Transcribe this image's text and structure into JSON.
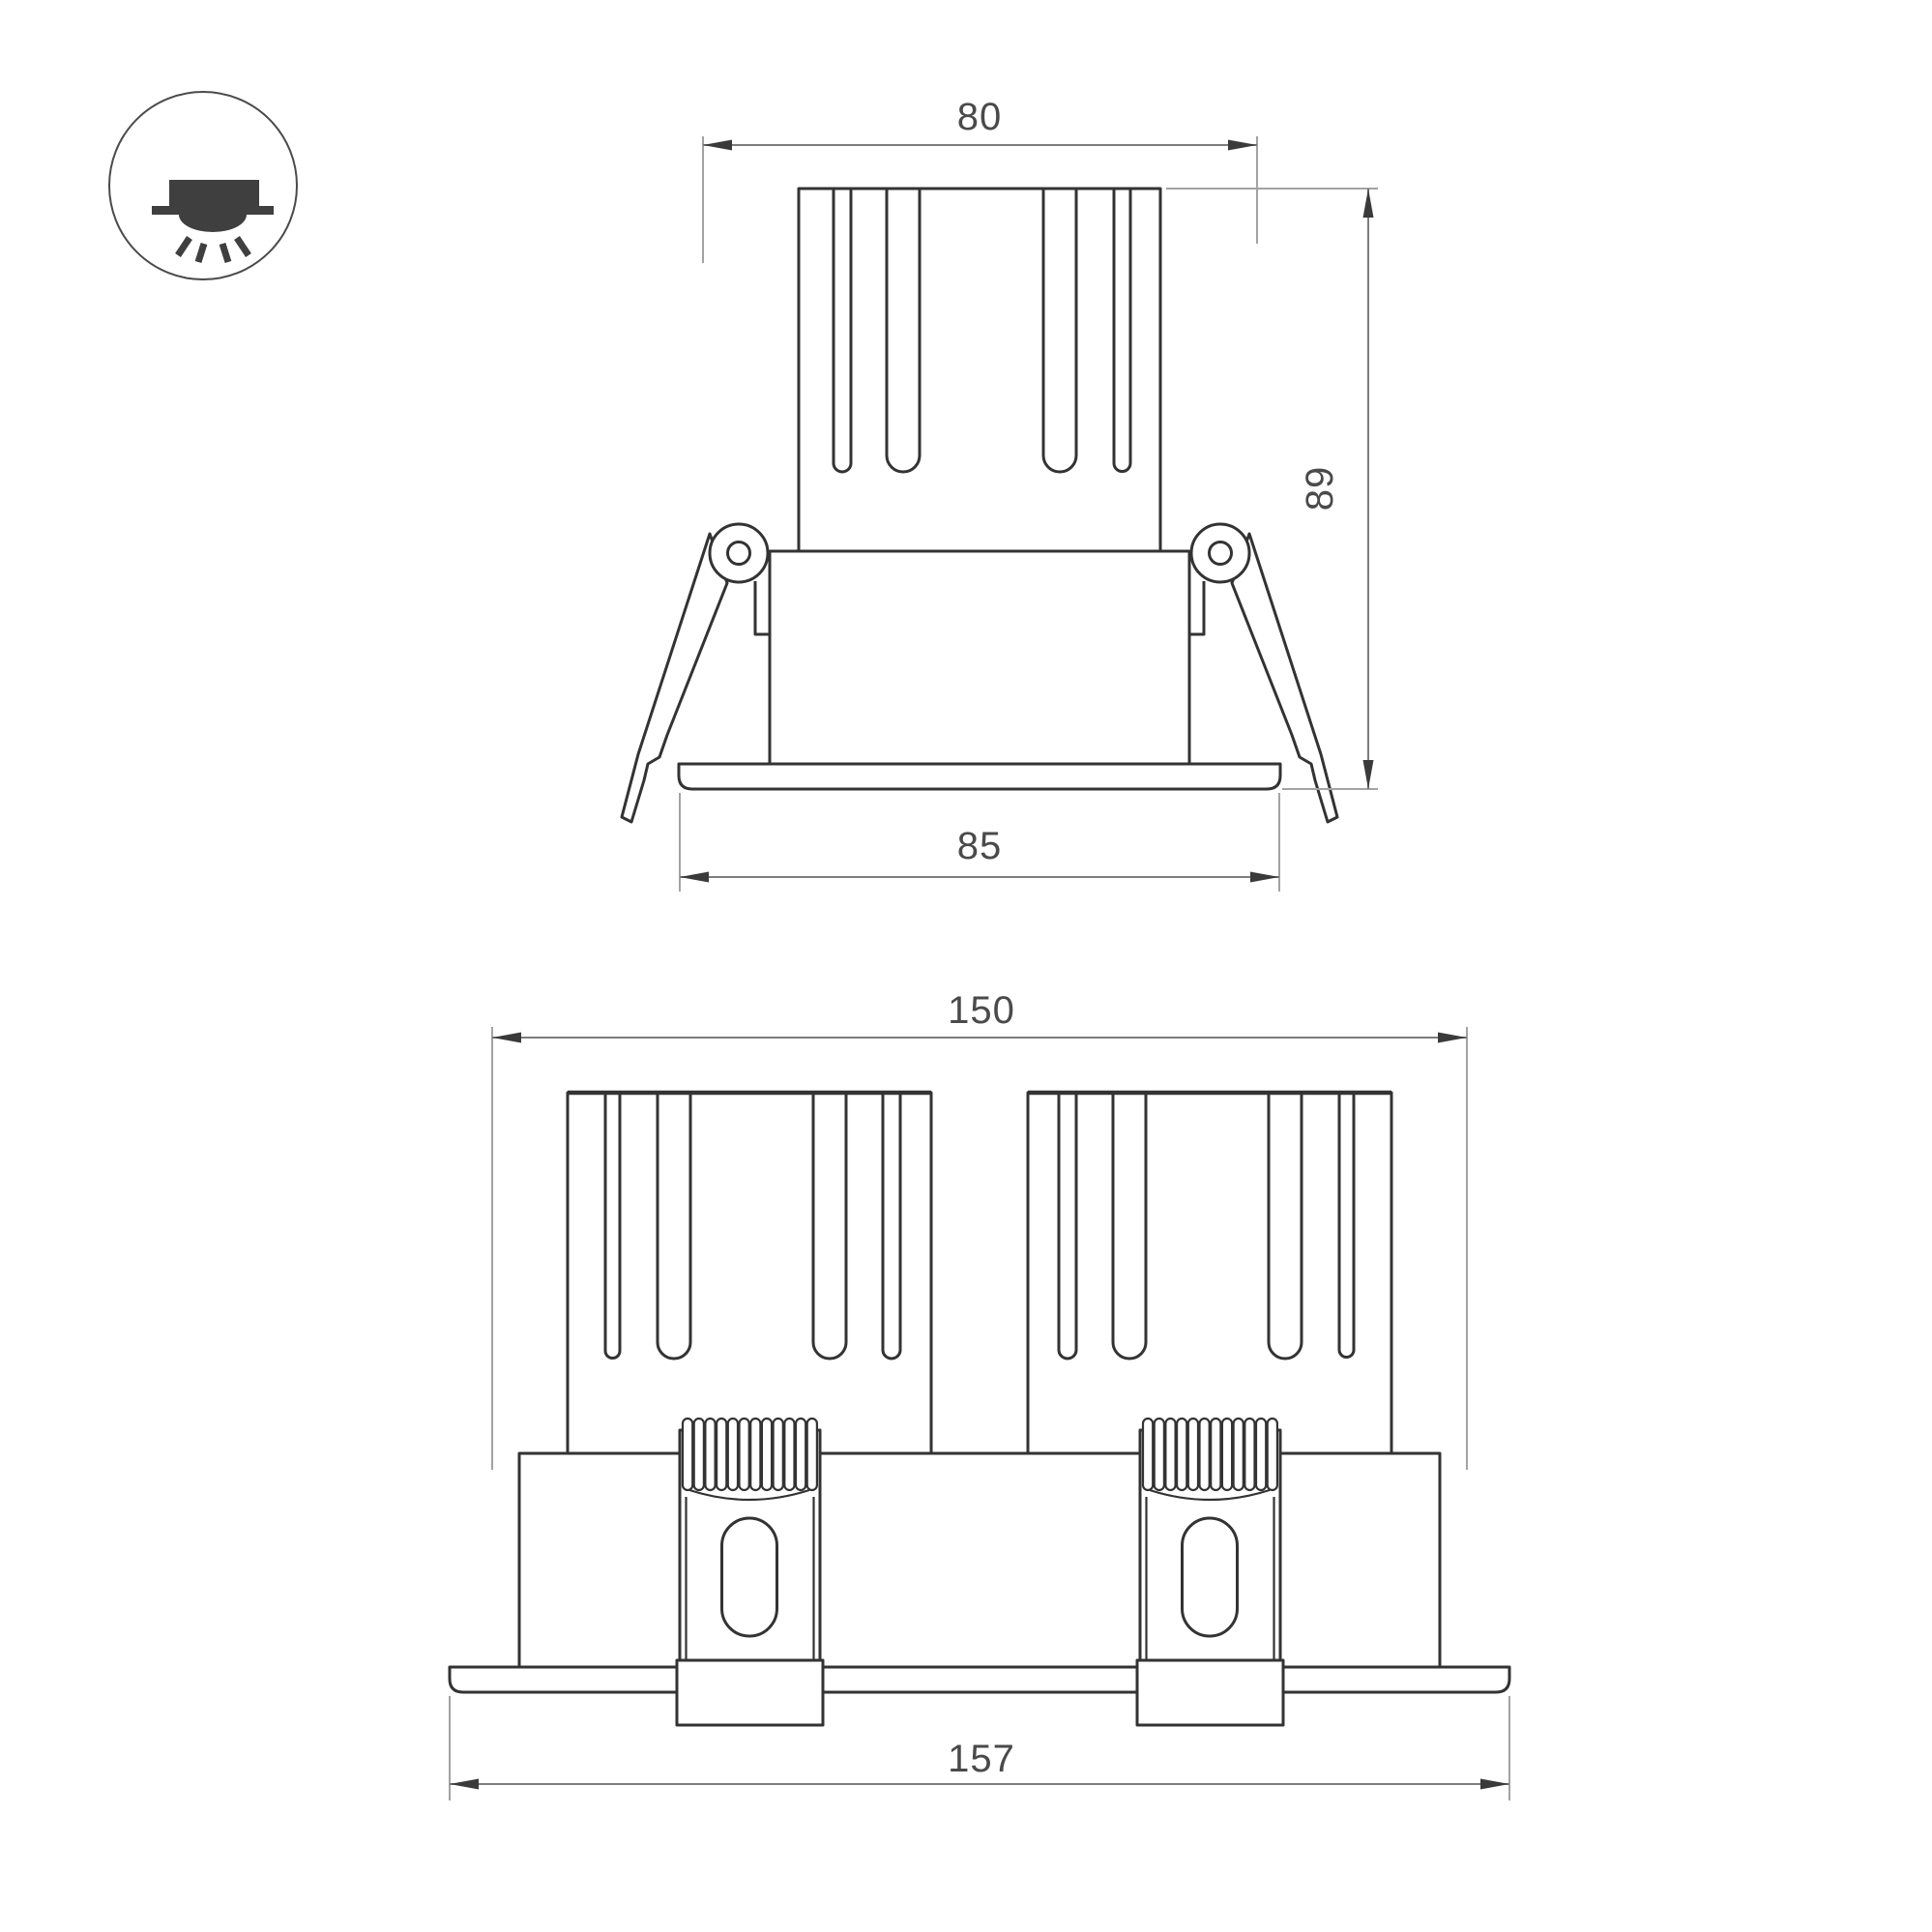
{
  "theme": {
    "background": "#ffffff",
    "object_line": "#333333",
    "dim_line": "#7d7d7d",
    "ext_line": "#a3a3a3",
    "arrow": "#3a3a3a",
    "text": "#4a4a4a",
    "icon_fill": "#3f3f3f",
    "icon_ring": "#4a4a4a"
  },
  "icon": {
    "name": "recessed-downlight-icon"
  },
  "views": {
    "single": {
      "name": "single-downlight-front-view",
      "dimensions": {
        "cutout_width": "80",
        "height": "89",
        "flange_width": "85"
      }
    },
    "double": {
      "name": "double-downlight-front-view",
      "dimensions": {
        "cutout_width": "150",
        "flange_width": "157"
      }
    }
  }
}
